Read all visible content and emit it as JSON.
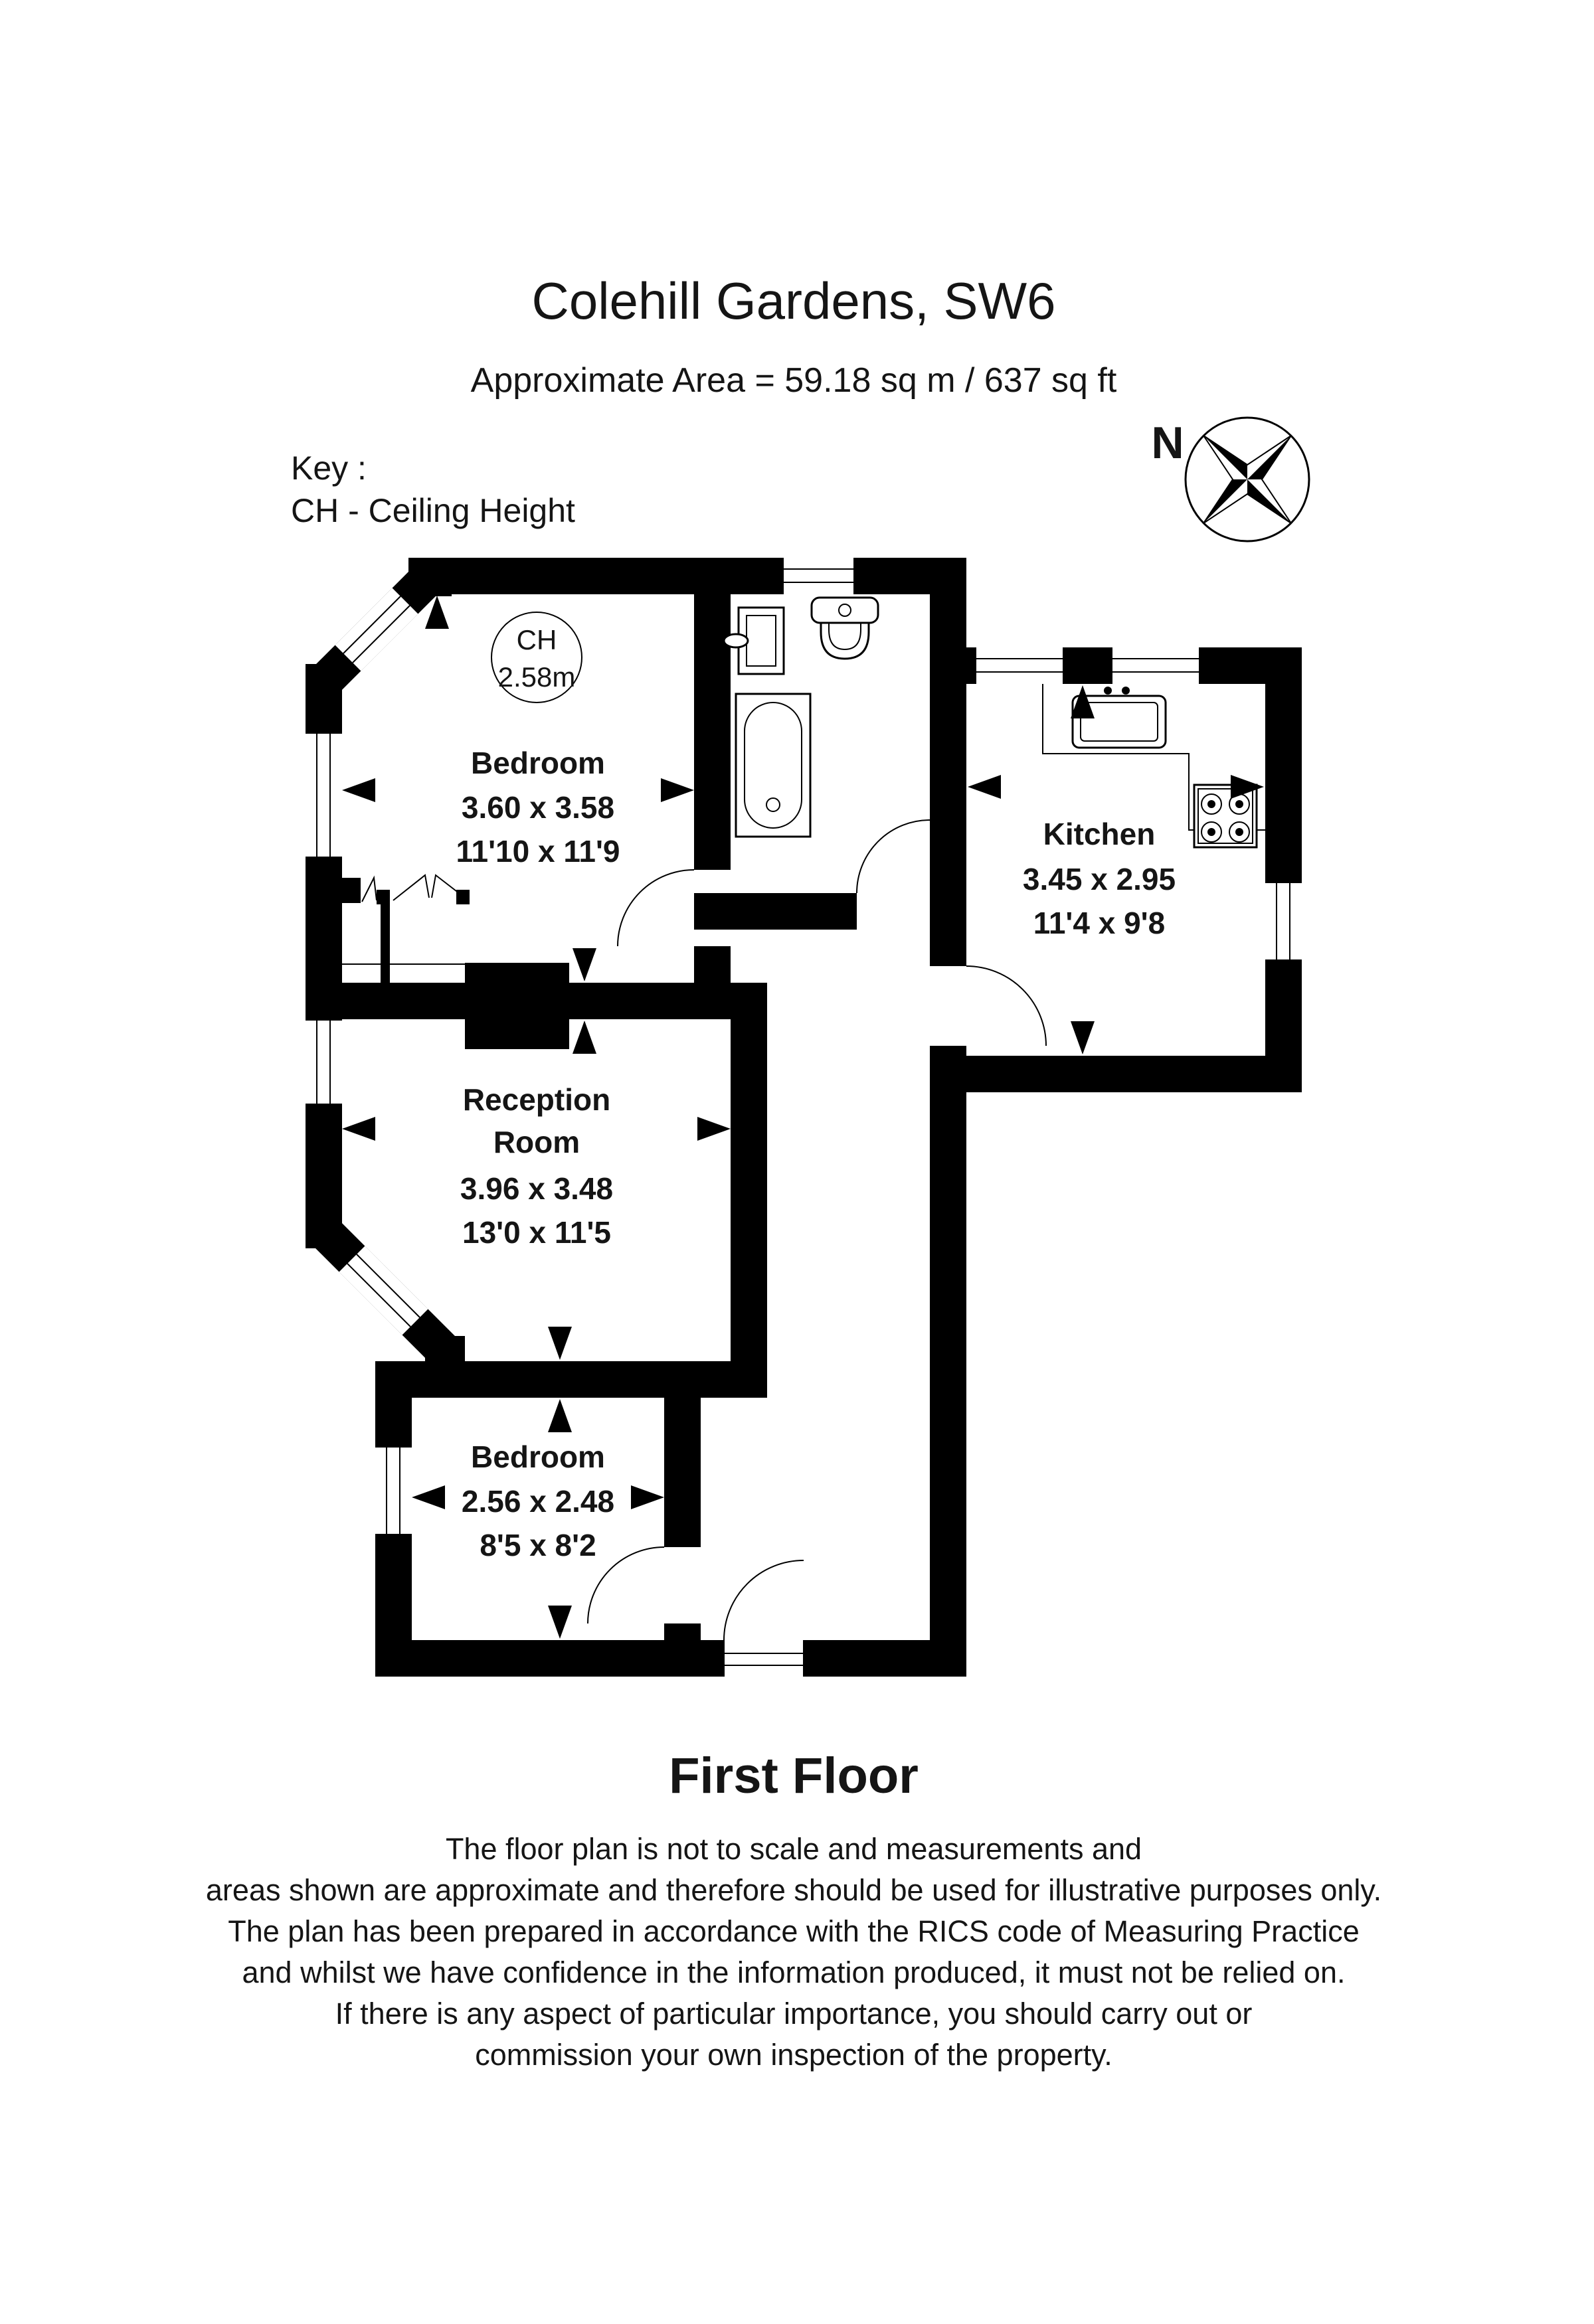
{
  "header": {
    "title": "Colehill Gardens, SW6",
    "area": "Approximate Area =  59.18 sq m / 637 sq ft"
  },
  "key": {
    "line1": "Key :",
    "line2": "CH - Ceiling Height"
  },
  "compass": {
    "north_label": "N"
  },
  "floor_plan": {
    "rooms": [
      {
        "id": "bedroom-1",
        "name": "Bedroom",
        "dim_m": "3.60 x 3.58",
        "dim_ft": "11'10 x 11'9",
        "ceiling_height": {
          "label": "CH",
          "value": "2.58m"
        }
      },
      {
        "id": "kitchen",
        "name": "Kitchen",
        "dim_m": "3.45 x 2.95",
        "dim_ft": "11'4 x 9'8"
      },
      {
        "id": "reception-room",
        "name_line1": "Reception",
        "name_line2": "Room",
        "dim_m": "3.96 x 3.48",
        "dim_ft": "13'0 x 11'5"
      },
      {
        "id": "bedroom-2",
        "name": "Bedroom",
        "dim_m": "2.56 x 2.48",
        "dim_ft": "8'5 x 8'2"
      }
    ]
  },
  "footer": {
    "floor_label": "First Floor",
    "disclaimer": [
      "The floor plan is not to scale and measurements and",
      "areas shown are approximate and therefore should be used for illustrative purposes only.",
      "The plan has been prepared in accordance with the RICS code of Measuring Practice",
      "and whilst we have confidence in the information produced, it must not be relied on.",
      "If there is any aspect of particular importance, you should carry out or",
      "commission your own inspection of the property."
    ]
  },
  "colors": {
    "wall": "#000000",
    "background": "#ffffff"
  }
}
